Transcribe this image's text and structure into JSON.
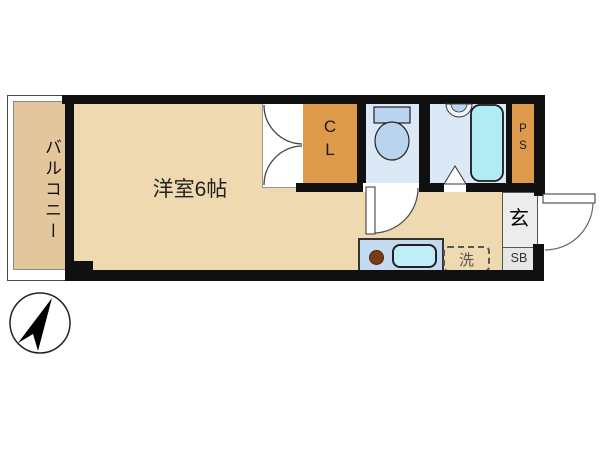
{
  "floorplan": {
    "balcony": {
      "label": "バルコニー"
    },
    "main_room": {
      "label": "洋室6帖"
    },
    "closet": {
      "letters": [
        "C",
        "L"
      ]
    },
    "pipe_space": {
      "letters": [
        "P",
        "S"
      ]
    },
    "entrance": {
      "label": "玄"
    },
    "shoe_box": {
      "label": "SB"
    },
    "laundry_space": {
      "label": "洗"
    },
    "icons": [
      "north-arrow-icon",
      "toilet-icon",
      "bathtub-icon",
      "wash-basin-icon",
      "kitchen-sink-icon",
      "burner-icon"
    ],
    "colors": {
      "wall": "#101010",
      "room_floor": "#eed9b0",
      "balcony_floor": "#e3c69c",
      "closet_fill": "#dd9a4a",
      "wet_area_fill": "#dbe8f6",
      "fixture_blue": "#b9d4ef",
      "bathtub_fill": "#b2ebf3",
      "kitchen_counter": "#c3daf0",
      "sink_fill": "#c0eef8",
      "burner_brown": "#7a3c18",
      "entrance_fill": "#ececec"
    }
  }
}
